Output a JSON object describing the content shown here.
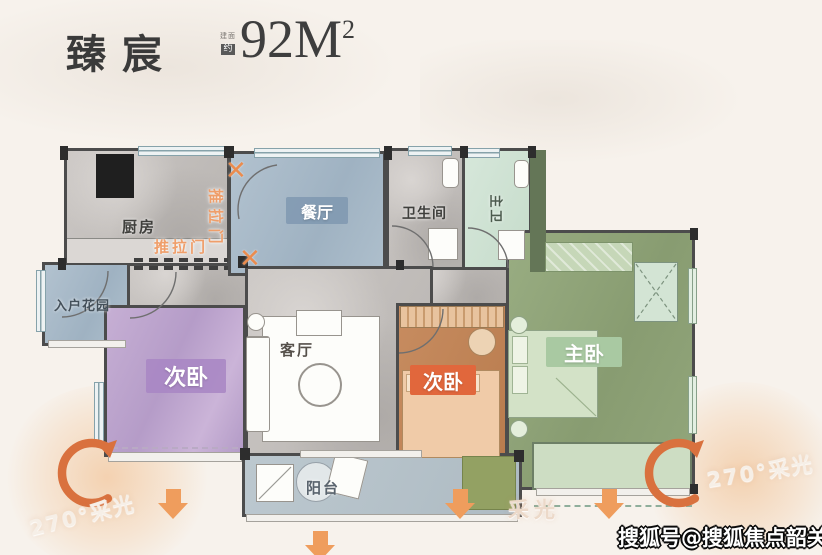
{
  "header": {
    "title": "臻宸",
    "area_prefix_top": "建面",
    "area_prefix_bottom": "约",
    "area_value": "92M",
    "area_exponent": "2"
  },
  "rooms": {
    "kitchen": "厨房",
    "dining": "餐厅",
    "bathroom": "卫生间",
    "master_bathroom": "主卫",
    "entry_garden": "入户花园",
    "bedroom_left": "次卧",
    "living_room": "客厅",
    "bedroom_middle": "次卧",
    "master_bedroom": "主卧",
    "balcony": "阳台"
  },
  "annotations": {
    "sliding_door_horizontal": "推拉门",
    "sliding_door_vertical": "推拉门",
    "demolish_mark": "✕",
    "daylight_bottom": "采光",
    "daylight_270_left": "270°采光",
    "daylight_270_right": "270°采光"
  },
  "watermark": {
    "text": "搜狐号@搜狐焦点韶关站"
  },
  "palette": {
    "background": "#F7F2EC",
    "wall": "#4C4C4C",
    "title_text": "#3A3A3A",
    "accent_orange": "#EF9D5D",
    "curve_arrow_orange": "#D9713E",
    "dining_blue": "#A8BAC7",
    "bedroom_purple": "#BCA5CD",
    "bedroom_terracotta": "#C1855A",
    "bed_peach": "#F0CBA8",
    "master_green": "#8FA477",
    "mint_green": "#CFE2D4",
    "balcony_blue": "#B6C3CA",
    "badge_orange": "#E1673C",
    "badge_green": "#A9C9A2",
    "badge_purple": "#B091C6",
    "badge_blue": "#8FA6BA",
    "sliding_door_text": "#EF9E6A"
  }
}
